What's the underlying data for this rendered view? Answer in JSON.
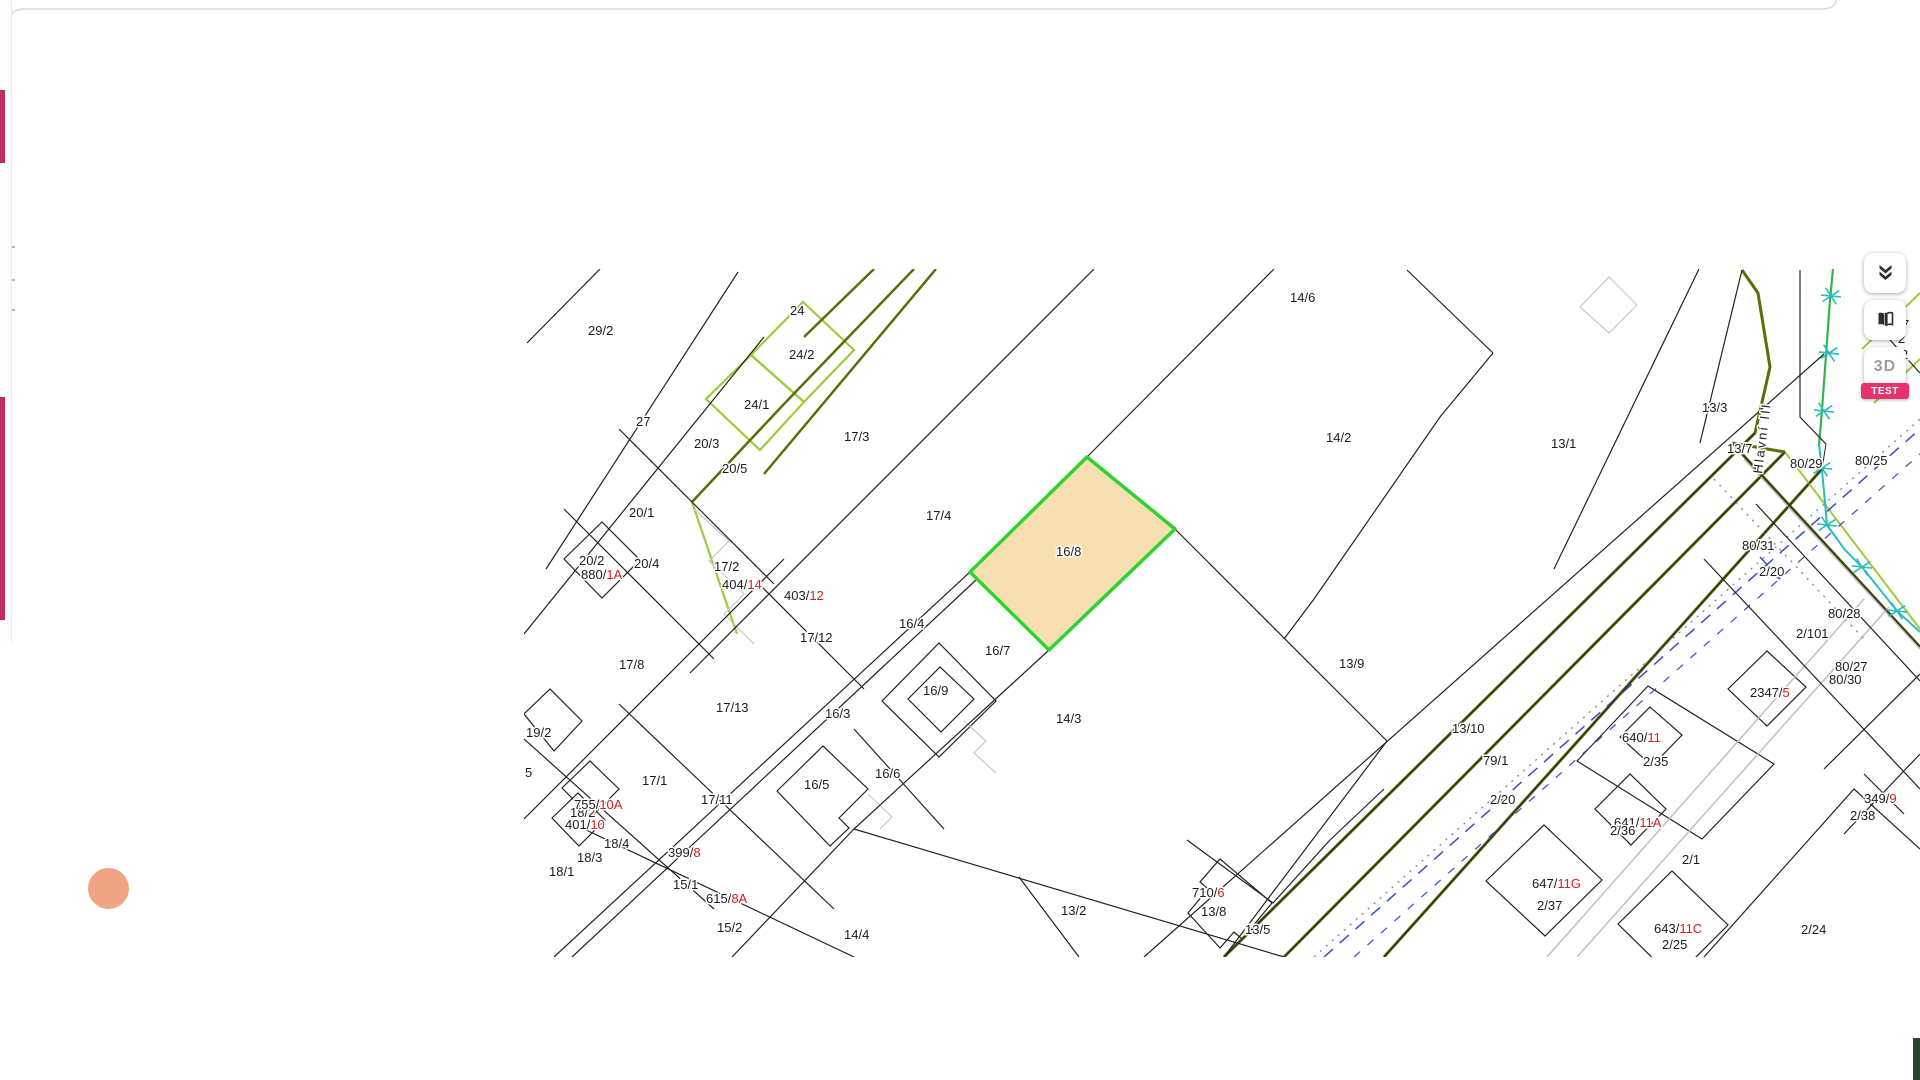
{
  "ui": {
    "background": "#ffffff",
    "panel_border_color": "#d9d9d9",
    "drawer": {
      "accent_color": "#c22a62",
      "bars": [
        {
          "top": 90,
          "height": 73
        },
        {
          "top": 397,
          "height": 223
        }
      ],
      "specks_y": [
        246,
        279,
        309
      ]
    },
    "orange_dot_color": "#efa583",
    "corner_fragment_color": "#2e4233",
    "controls": {
      "layers_icon": "layers-collapse-icon",
      "compare_icon": "map-compare-icon",
      "three_d_label": "3D",
      "test_badge": "TEST",
      "badge_color": "#e73272"
    }
  },
  "map": {
    "palette": {
      "k": "#222222",
      "olive": "#5a6e08",
      "lime": "#9ccb3b",
      "lgreen": "#8aa431",
      "road": "#c0c0c0",
      "lgray": "#c9c9c9",
      "blue": "#3a49cf",
      "teal": "#2bbcbc",
      "green": "#36b44a",
      "dot": "#8a8a8a",
      "red": "#d42020"
    },
    "street_label": {
      "t": "Hlavní III",
      "x": 1238,
      "y": 205,
      "rot": -83
    },
    "highlight": {
      "id": "16/8",
      "fill": "#f8dfb2",
      "stroke": "#2fd32f",
      "points": "446,303 563,188 651,260 525,381"
    },
    "geometry": {
      "lines": [
        {
          "p": "390,0 260,135 168,233",
          "c": "olive",
          "w": 2.5
        },
        {
          "p": "168,233 213,365",
          "c": "lime",
          "w": 2.2
        },
        {
          "p": "412,0 282,155 240,205",
          "c": "olive",
          "w": 2.5
        },
        {
          "p": "350,0 280,68",
          "c": "olive",
          "w": 2.5
        },
        {
          "p": "700,688 1231,164 1246,98 1234,24 1218,1",
          "c": "olive",
          "w": 3
        },
        {
          "p": "760,688 1261,183",
          "c": "olive",
          "w": 3
        },
        {
          "p": "860,688 1298,200",
          "c": "olive",
          "w": 3
        },
        {
          "p": "1208,174 1396,378",
          "c": "olive",
          "w": 3
        },
        {
          "p": "1208,174 1261,183",
          "c": "olive",
          "w": 3
        },
        {
          "p": "1261,183 1396,360",
          "c": "lime",
          "w": 2
        },
        {
          "p": "1338,80 1396,24",
          "c": "lime",
          "w": 2
        },
        {
          "p": "1350,134 1396,90",
          "c": "lime",
          "w": 2
        },
        {
          "p": "1023,688 1340,330",
          "c": "road",
          "w": 1.5
        },
        {
          "p": "1053,688 1365,338",
          "c": "road",
          "w": 1.5
        },
        {
          "p": "1220,190 1396,380",
          "c": "road",
          "w": 1.5
        },
        {
          "p": "170,240 205,272 185,292 220,325 200,345 230,375",
          "c": "lgray",
          "w": 1.2
        },
        {
          "p": "440,452 462,472 450,484 472,504",
          "c": "lgray",
          "w": 1.2
        },
        {
          "p": "344,525 368,548 356,560",
          "c": "lgray",
          "w": 1.2
        },
        {
          "p": "800,688 1396,160",
          "c": "blue",
          "w": 1.5,
          "dash": "12 9"
        },
        {
          "p": "830,688 1396,185",
          "c": "blue",
          "w": 1.2,
          "dash": "8 10"
        },
        {
          "p": "1236,288 1256,310",
          "c": "blue",
          "w": 1.5
        },
        {
          "p": "1256,310 1247,305",
          "c": "blue",
          "w": 1.5
        },
        {
          "p": "1256,310 1252,300",
          "c": "blue",
          "w": 1.5
        },
        {
          "p": "790,688 1396,150",
          "c": "dot",
          "w": 1.4,
          "dash": "2 6"
        },
        {
          "p": "1190,210 1340,370",
          "c": "dot",
          "w": 1.4,
          "dash": "2 6"
        },
        {
          "p": "1309,0 1306,31 1302,86 1298,141 1295,176",
          "c": "green",
          "w": 2.2
        },
        {
          "p": "1295,176 1298,201 1303,256 1321,281 1338,298 1373,342 1396,363",
          "c": "teal",
          "w": 2
        },
        {
          "p": "3,74 76,0",
          "c": "k",
          "w": 1.2
        },
        {
          "p": "22,300 214,3",
          "c": "k",
          "w": 1.2
        },
        {
          "p": "0,365 240,68",
          "c": "k",
          "w": 1.2
        },
        {
          "p": "95,160 250,315",
          "c": "k",
          "w": 1.2
        },
        {
          "p": "40,240 190,390",
          "c": "k",
          "w": 1.2
        },
        {
          "p": "0,550 260,290",
          "c": "k",
          "w": 1.2
        },
        {
          "p": "0,470 190,640",
          "c": "k",
          "w": 1.2
        },
        {
          "p": "95,435 310,640",
          "c": "k",
          "w": 1.2
        },
        {
          "p": "60,560 330,688",
          "c": "k",
          "w": 1.2
        },
        {
          "p": "30,688 446,303 563,188 750,0",
          "c": "k",
          "w": 1.2
        },
        {
          "p": "48,688 452,311",
          "c": "k",
          "w": 1.2
        },
        {
          "p": "166,404 570,0",
          "c": "k",
          "w": 1.2
        },
        {
          "p": "235,315 340,420",
          "c": "k",
          "w": 1.2
        },
        {
          "p": "651,260 863,472",
          "c": "k",
          "w": 1.2
        },
        {
          "p": "525,381 330,560",
          "c": "k",
          "w": 1.2
        },
        {
          "p": "330,560 208,688",
          "c": "k",
          "w": 1.2
        },
        {
          "p": "330,560 760,688",
          "c": "k",
          "w": 1.2
        },
        {
          "p": "495,608 555,688",
          "c": "k",
          "w": 1.2
        },
        {
          "p": "863,472 700,688",
          "c": "k",
          "w": 1.2
        },
        {
          "p": "663,571 749,634 806,571 860,520",
          "c": "k",
          "w": 1.2
        },
        {
          "p": "883,1 969,84",
          "c": "k",
          "w": 1.2
        },
        {
          "p": "969,84 916,148 790,330 760,370",
          "c": "k",
          "w": 1.2
        },
        {
          "p": "1030,300 1175,0",
          "c": "k",
          "w": 1.2
        },
        {
          "p": "620,688 1300,85",
          "c": "k",
          "w": 1.2
        },
        {
          "p": "1176,174 1218,1",
          "c": "k",
          "w": 1.2
        },
        {
          "p": "1276,1 1276,148 1302,175",
          "c": "k",
          "w": 1.2
        },
        {
          "p": "700,688 1231,164",
          "c": "k",
          "w": 1
        },
        {
          "p": "760,688 1261,183",
          "c": "k",
          "w": 1
        },
        {
          "p": "860,688 1298,200 1302,175",
          "c": "k",
          "w": 1
        },
        {
          "p": "1208,174 1396,378",
          "c": "k",
          "w": 1
        },
        {
          "p": "1232,235 1396,412",
          "c": "k",
          "w": 1.2
        },
        {
          "p": "1180,290 1396,520",
          "c": "k",
          "w": 1.2
        },
        {
          "p": "1180,688 1330,520 1396,580",
          "c": "k",
          "w": 1.2
        },
        {
          "p": "1300,500 1396,405",
          "c": "k",
          "w": 1.2
        },
        {
          "p": "1320,565 1396,485",
          "c": "k",
          "w": 1.2
        },
        {
          "p": "1340,505 1380,545",
          "c": "k",
          "w": 1.2
        },
        {
          "p": "330,460 420,560",
          "c": "k",
          "w": 1.2
        },
        {
          "p": "1356,60 1396,104",
          "c": "k",
          "w": 1.2
        }
      ],
      "polygons": [
        {
          "p": "279,33 330,81 280,133 227,86",
          "c": "lime",
          "w": 2.2
        },
        {
          "p": "227,86 280,133 236,181 182,130",
          "c": "lime",
          "w": 2.2
        },
        {
          "p": "40,290 78,253 116,291 78,329",
          "c": "k",
          "w": 1.2
        },
        {
          "p": "0,445 26,420 58,452 30,482",
          "c": "k",
          "w": 1.2
        },
        {
          "p": "358,432 415,374 472,432 415,488",
          "c": "k",
          "w": 1.2
        },
        {
          "p": "384,430 416,398 450,430 417,463",
          "c": "k",
          "w": 1.2
        },
        {
          "p": "253,522 299,477 344,520 315,549 325,559 306,577",
          "c": "k",
          "w": 1.2
        },
        {
          "p": "38,519 66,492 95,520 67,548",
          "c": "k",
          "w": 1.2
        },
        {
          "p": "28,549 54,524 81,551 55,577",
          "c": "k",
          "w": 1.2
        },
        {
          "p": "664,644 684,620 676,613 696,590 748,634 718,670 710,663 696,679",
          "c": "k",
          "w": 1.2
        },
        {
          "p": "1204,420 1243,382 1282,418 1243,457",
          "c": "k",
          "w": 1.2
        },
        {
          "p": "1096,468 1126,438 1158,466 1128,497",
          "c": "k",
          "w": 1.2
        },
        {
          "p": "1071,540 1106,505 1142,540 1107,576",
          "c": "k",
          "w": 1.2
        },
        {
          "p": "962,612 1020,556 1078,611 1021,667",
          "c": "k",
          "w": 1.2
        },
        {
          "p": "1094,655 1148,602 1204,656 1150,710",
          "c": "k",
          "w": 1.2
        },
        {
          "p": "1053,492 1124,417 1250,495 1178,570",
          "c": "k",
          "w": 1.2
        },
        {
          "p": "1056,38 1085,8 1113,36 1085,64",
          "c": "lgray",
          "w": 1.2
        }
      ]
    },
    "markers": {
      "color": "teal",
      "points": [
        [
          1307,
          27
        ],
        [
          1305,
          84
        ],
        [
          1300,
          142
        ],
        [
          1298,
          199
        ],
        [
          1303,
          256
        ],
        [
          1338,
          298
        ],
        [
          1373,
          342
        ]
      ]
    },
    "labels": [
      {
        "t": "29/2",
        "x": 64,
        "y": 66
      },
      {
        "t": "27",
        "x": 112,
        "y": 157
      },
      {
        "t": "24",
        "x": 266,
        "y": 46
      },
      {
        "t": "24/2",
        "x": 265,
        "y": 90,
        "c": "lgreen"
      },
      {
        "t": "24/1",
        "x": 220,
        "y": 140,
        "c": "lgreen"
      },
      {
        "t": "20/3",
        "x": 170,
        "y": 179
      },
      {
        "t": "20/5",
        "x": 198,
        "y": 204
      },
      {
        "t": "20/1",
        "x": 105,
        "y": 248
      },
      {
        "t": "20/2",
        "x": 55,
        "y": 296
      },
      {
        "t": "20/4",
        "x": 110,
        "y": 299
      },
      {
        "pre": "880/",
        "suf": "1A",
        "x": 57,
        "y": 310
      },
      {
        "t": "17/3",
        "x": 320,
        "y": 172
      },
      {
        "t": "17/4",
        "x": 402,
        "y": 251
      },
      {
        "t": "17/2",
        "x": 190,
        "y": 302
      },
      {
        "pre": "404/",
        "suf": "14",
        "x": 198,
        "y": 320
      },
      {
        "pre": "403/",
        "suf": "12",
        "x": 260,
        "y": 331
      },
      {
        "t": "17/12",
        "x": 276,
        "y": 373
      },
      {
        "t": "17/8",
        "x": 95,
        "y": 400
      },
      {
        "t": "17/13",
        "x": 192,
        "y": 443
      },
      {
        "t": "17/1",
        "x": 118,
        "y": 516
      },
      {
        "t": "17/11",
        "x": 177,
        "y": 535
      },
      {
        "t": "18/2",
        "x": 46,
        "y": 548
      },
      {
        "pre": "755/",
        "suf": "10A",
        "x": 50,
        "y": 540
      },
      {
        "pre": "401/",
        "suf": "10",
        "x": 41,
        "y": 560
      },
      {
        "t": "18/4",
        "x": 80,
        "y": 579
      },
      {
        "t": "18/3",
        "x": 53,
        "y": 593
      },
      {
        "t": "18/1",
        "x": 25,
        "y": 607
      },
      {
        "t": "19/2",
        "x": 2,
        "y": 468
      },
      {
        "t": "5",
        "x": 1,
        "y": 508,
        "c": "red"
      },
      {
        "pre": "399/",
        "suf": "8",
        "x": 144,
        "y": 588
      },
      {
        "t": "15/1",
        "x": 149,
        "y": 620
      },
      {
        "pre": "615/",
        "suf": "8A",
        "x": 182,
        "y": 634
      },
      {
        "t": "15/2",
        "x": 193,
        "y": 663
      },
      {
        "t": "16/8",
        "x": 532,
        "y": 287
      },
      {
        "t": "16/4",
        "x": 375,
        "y": 359
      },
      {
        "t": "16/7",
        "x": 461,
        "y": 386
      },
      {
        "t": "16/9",
        "x": 399,
        "y": 426
      },
      {
        "t": "16/3",
        "x": 301,
        "y": 449
      },
      {
        "t": "16/5",
        "x": 280,
        "y": 520
      },
      {
        "t": "16/6",
        "x": 351,
        "y": 509
      },
      {
        "t": "14/4",
        "x": 320,
        "y": 670
      },
      {
        "t": "14/3",
        "x": 532,
        "y": 454
      },
      {
        "t": "14/6",
        "x": 766,
        "y": 33
      },
      {
        "t": "14/2",
        "x": 802,
        "y": 173
      },
      {
        "t": "13/1",
        "x": 1027,
        "y": 179
      },
      {
        "t": "13/3",
        "x": 1178,
        "y": 143
      },
      {
        "t": "13/7",
        "x": 1203,
        "y": 184
      },
      {
        "t": "13/9",
        "x": 815,
        "y": 399
      },
      {
        "t": "13/2",
        "x": 537,
        "y": 646
      },
      {
        "pre": "710/",
        "suf": "6",
        "x": 668,
        "y": 628
      },
      {
        "t": "13/8",
        "x": 677,
        "y": 647
      },
      {
        "t": "13/5",
        "x": 721,
        "y": 665
      },
      {
        "t": "13/10",
        "x": 928,
        "y": 464
      },
      {
        "t": "79/1",
        "x": 959,
        "y": 496
      },
      {
        "t": "2/20",
        "x": 966,
        "y": 535
      },
      {
        "pre": "640/",
        "suf": "11",
        "x": 1098,
        "y": 473
      },
      {
        "t": "2/35",
        "x": 1119,
        "y": 497
      },
      {
        "pre": "641/",
        "suf": "11A",
        "x": 1090,
        "y": 558
      },
      {
        "t": "2/36",
        "x": 1086,
        "y": 566
      },
      {
        "t": "2/1",
        "x": 1158,
        "y": 595
      },
      {
        "pre": "647/",
        "suf": "11G",
        "x": 1008,
        "y": 619
      },
      {
        "t": "2/37",
        "x": 1013,
        "y": 641
      },
      {
        "pre": "643/",
        "suf": "11C",
        "x": 1130,
        "y": 664
      },
      {
        "t": "2/25",
        "x": 1138,
        "y": 680
      },
      {
        "t": "2/24",
        "x": 1277,
        "y": 665
      },
      {
        "t": "2/38",
        "x": 1326,
        "y": 551
      },
      {
        "pre": "349/",
        "suf": "9",
        "x": 1340,
        "y": 534
      },
      {
        "t": "80/31",
        "x": 1218,
        "y": 281
      },
      {
        "t": "2/20",
        "x": 1235,
        "y": 307,
        "c": "lime"
      },
      {
        "t": "80/28",
        "x": 1304,
        "y": 349
      },
      {
        "t": "2/101",
        "x": 1272,
        "y": 369,
        "c": "lime"
      },
      {
        "t": "80/27",
        "x": 1311,
        "y": 402
      },
      {
        "t": "80/30",
        "x": 1305,
        "y": 415
      },
      {
        "pre": "2347/",
        "suf": "5",
        "x": 1226,
        "y": 428
      },
      {
        "t": "80/25",
        "x": 1331,
        "y": 196
      },
      {
        "t": "80/29",
        "x": 1266,
        "y": 199
      },
      {
        "t": "7",
        "x": 1378,
        "y": 60
      },
      {
        "t": "2",
        "x": 1374,
        "y": 74,
        "c": "lgreen"
      },
      {
        "t": "0/2",
        "x": 1366,
        "y": 90
      }
    ]
  }
}
